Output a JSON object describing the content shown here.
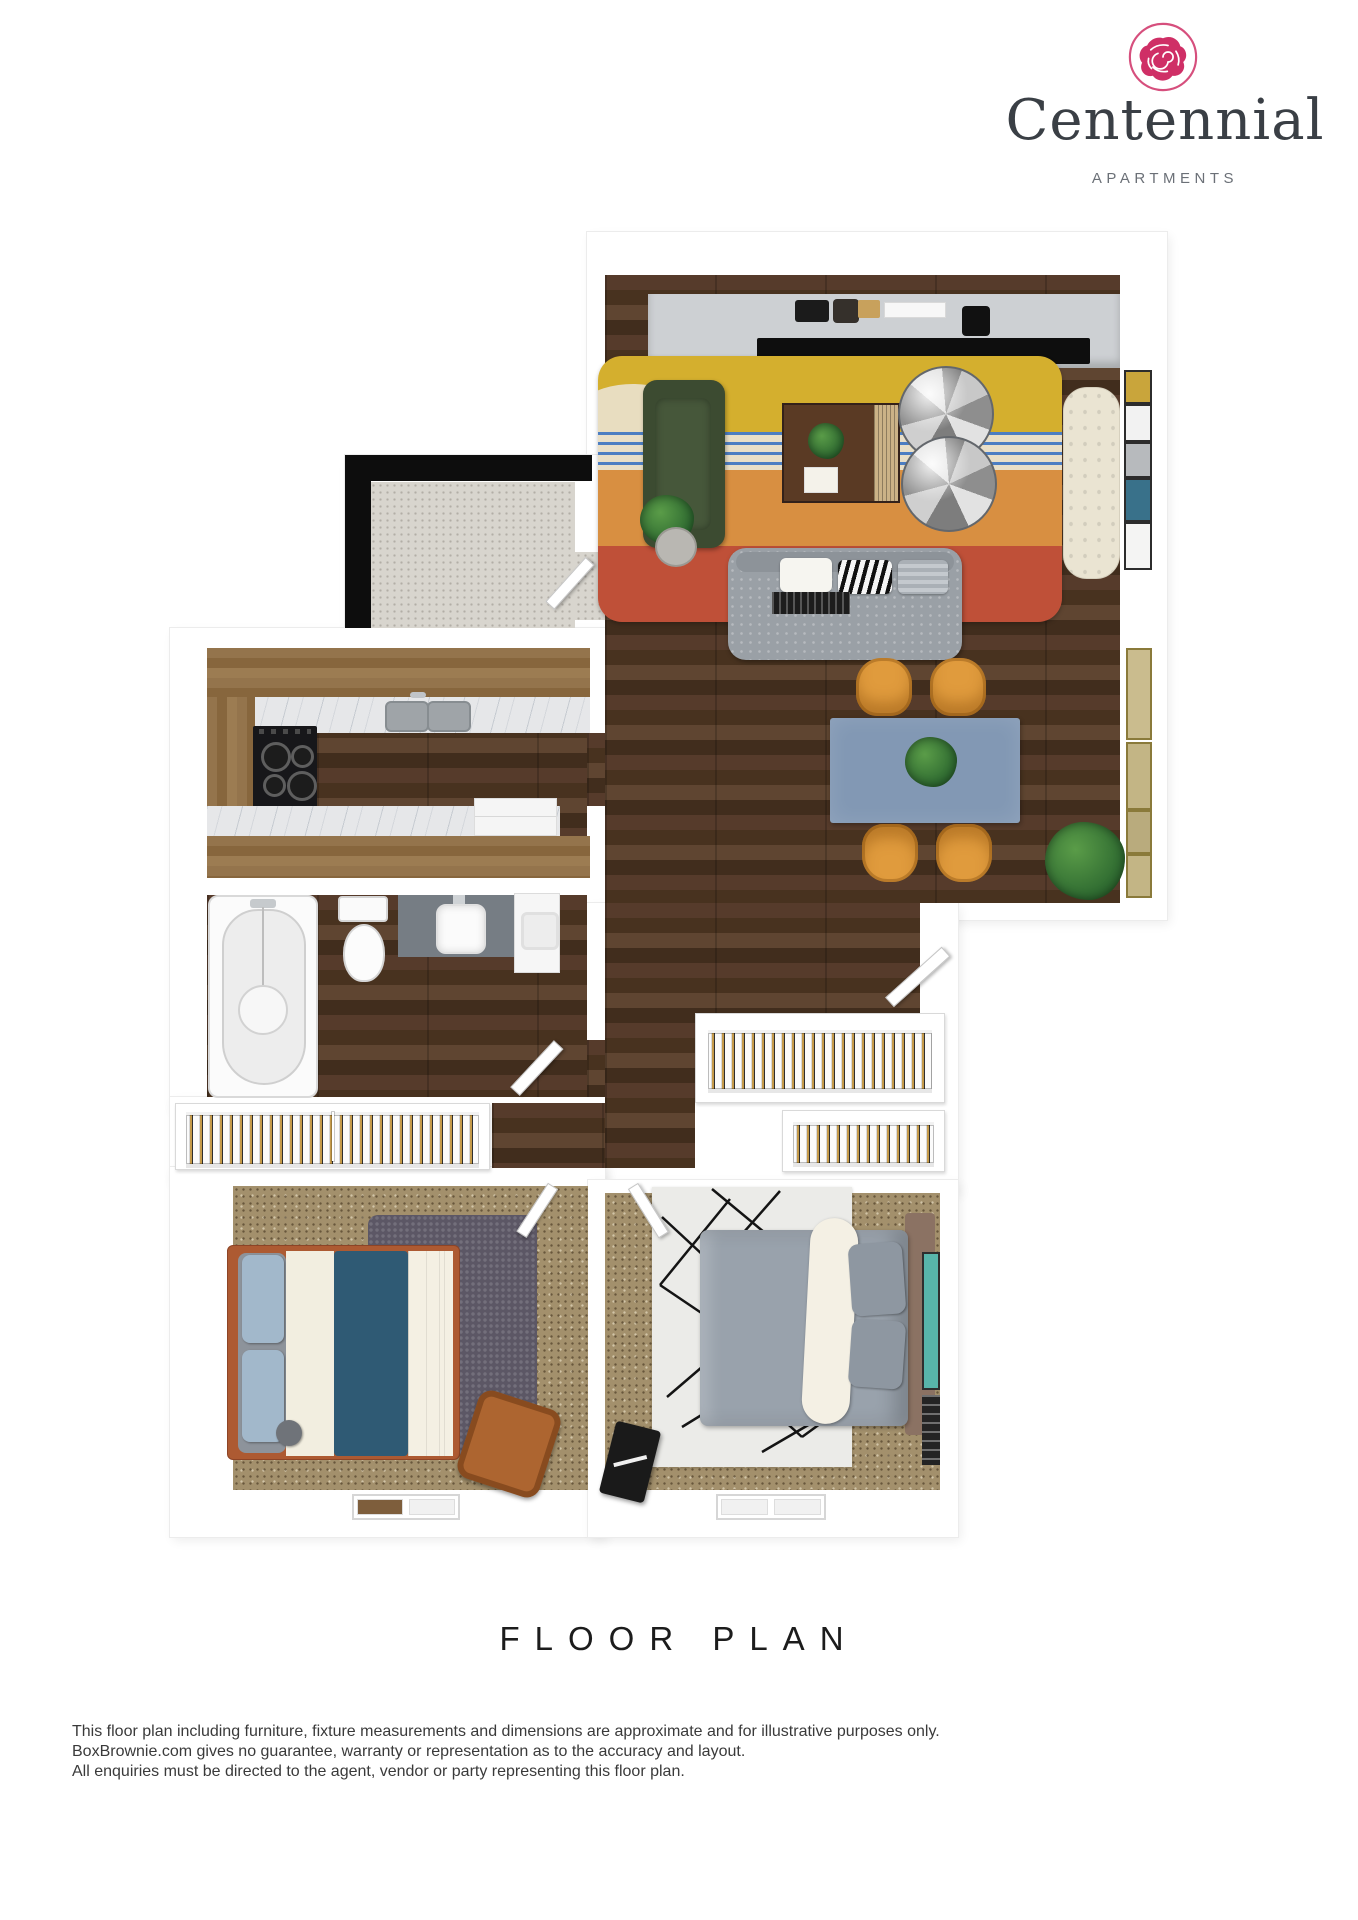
{
  "logo": {
    "name": "Centennial",
    "tagline": "APARTMENTS"
  },
  "title": "FLOOR PLAN",
  "disclaimer": {
    "lines": [
      "This floor plan including furniture, fixture measurements and dimensions are approximate and for illustrative purposes only.",
      "BoxBrownie.com gives no guarantee, warranty or representation as to the accuracy and layout.",
      "All enquiries must be directed to the agent, vendor or party representing this floor plan."
    ]
  },
  "colors": {
    "brand_rose": "#d23a6e",
    "logo_text": "#3a3f45",
    "logo_sub": "#6b7077",
    "title_text": "#1c1c1c",
    "body_text": "#3a3a3a",
    "wall": "#ffffff",
    "wall_edge": "#ececec",
    "wood_dark": "#4a3428",
    "wood_light": "#8d6b44",
    "marble": "#e6e7e9",
    "concrete": "#d8d5ce",
    "carpet": "#a3906c",
    "balcony_frame": "#0d0d0d",
    "sofa_gray": "#9aa0a6",
    "rug_yellow": "#d4af2e",
    "rug_orange": "#d88f41",
    "rug_red": "#bf5038",
    "rug_cream": "#e9dfc8",
    "rug_blue": "#4d7ec2",
    "armchair_green": "#3c4b31",
    "table_blue": "#8298b4",
    "chair_orange": "#e09b3d",
    "chaise_cream": "#eae4d2",
    "console_gray": "#cdd0d3",
    "bed1_frame": "#ad5a32",
    "bed1_teal": "#2f5a74",
    "bed1_pillow": "#a2b8cb",
    "shag_gray": "#5c5765",
    "chair_leather": "#ad6530",
    "bed2_gray": "#99a2ac",
    "bed2_headboard": "#8b7263",
    "teal_mirror": "#58b5aa",
    "louver_tan": "#c49a4a"
  }
}
